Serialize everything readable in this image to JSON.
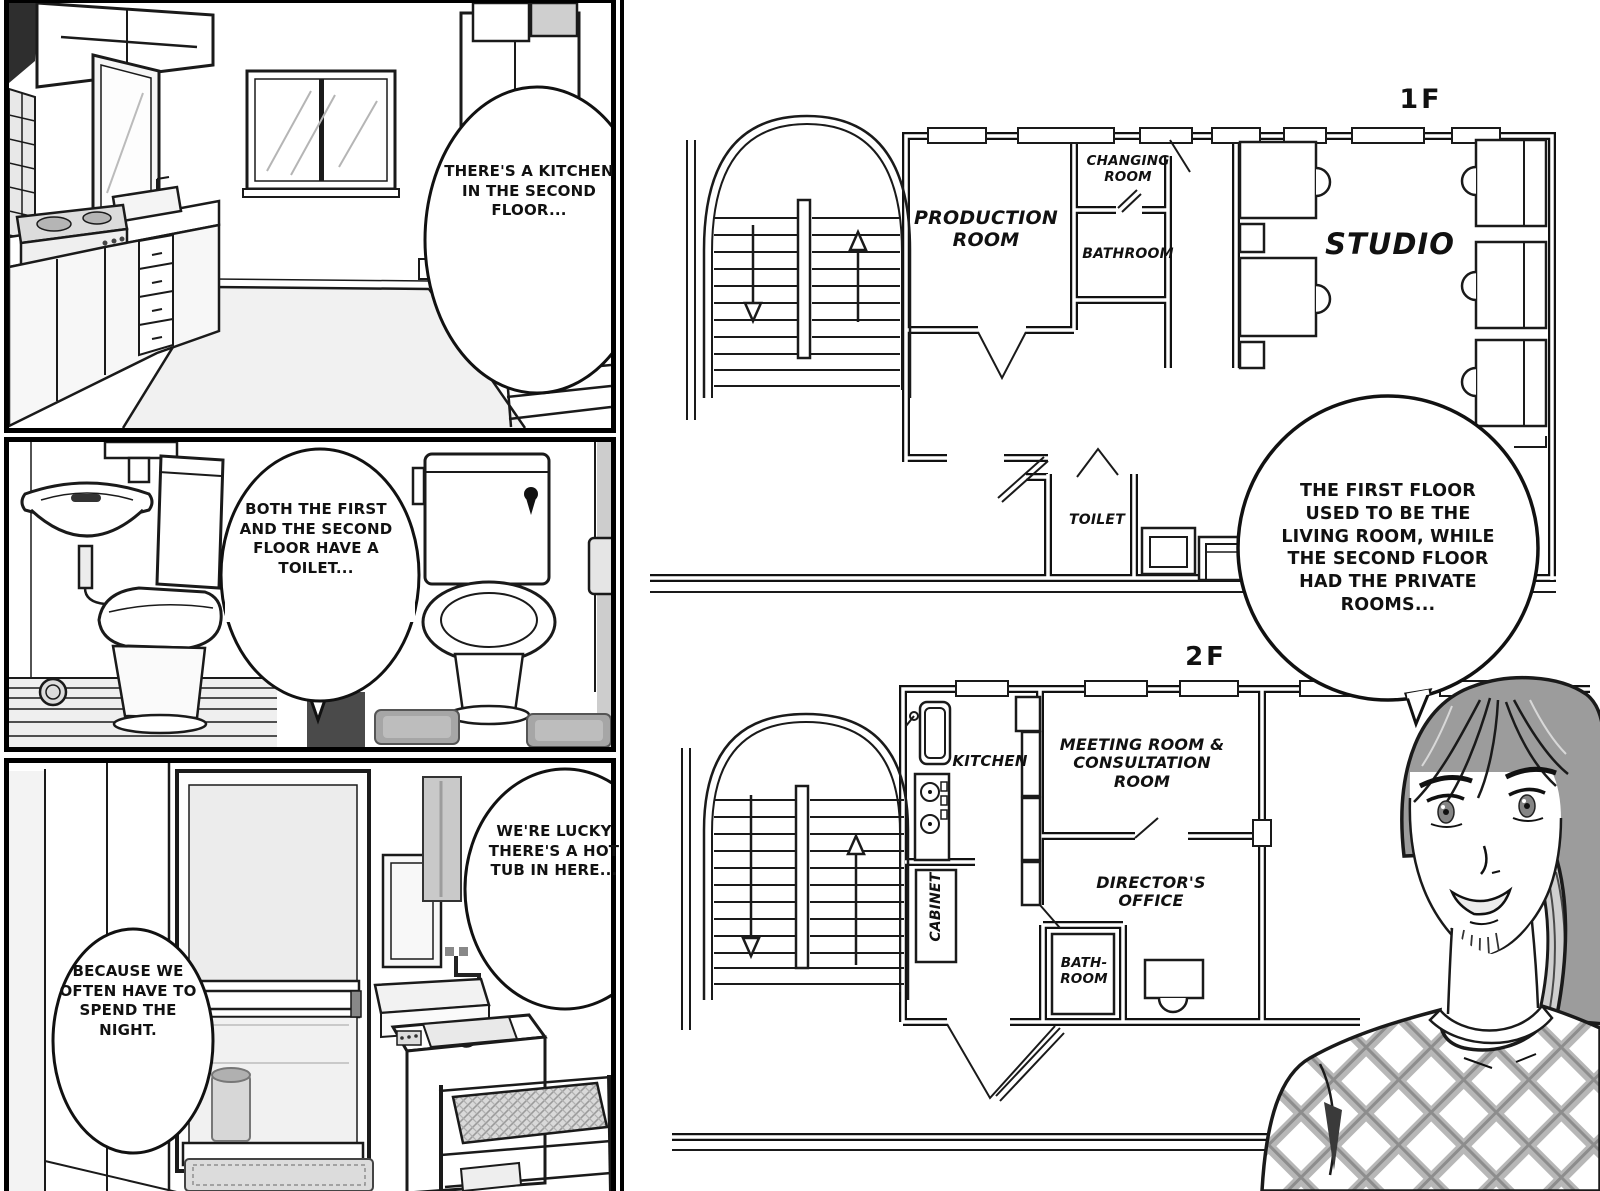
{
  "colors": {
    "ink": "#1a1a1a",
    "paper": "#ffffff",
    "hair_tone": "#9c9c9c",
    "screentone": "#c9c9c9"
  },
  "panels": {
    "kitchen": {
      "bubble": "THERE'S A KITCHEN IN THE SECOND FLOOR..."
    },
    "toilet": {
      "bubble": "BOTH THE FIRST AND THE SECOND FLOOR HAVE A TOILET..."
    },
    "bath": {
      "bubble_hot_tub": "WE'RE LUCKY THERE'S A HOT TUB IN HERE...",
      "bubble_night": "BECAUSE WE OFTEN HAVE TO SPEND THE NIGHT."
    }
  },
  "floorplan_1f": {
    "floor_label": "1F",
    "production_room": "PRODUCTION ROOM",
    "changing_room": "CHANGING ROOM",
    "bathroom": "BATHROOM",
    "studio": "STUDIO",
    "toilet": "TOILET"
  },
  "floorplan_2f": {
    "floor_label": "2F",
    "kitchen": "KITCHEN",
    "meeting_room": "MEETING ROOM & CONSULTATION ROOM",
    "cabinet": "CABINET",
    "directors_office": "DIRECTOR'S OFFICE",
    "bathroom": "BATH-ROOM"
  },
  "narration": {
    "explain_bubble": "THE FIRST FLOOR USED TO BE THE LIVING ROOM, WHILE THE SECOND FLOOR HAD THE PRIVATE ROOMS..."
  }
}
